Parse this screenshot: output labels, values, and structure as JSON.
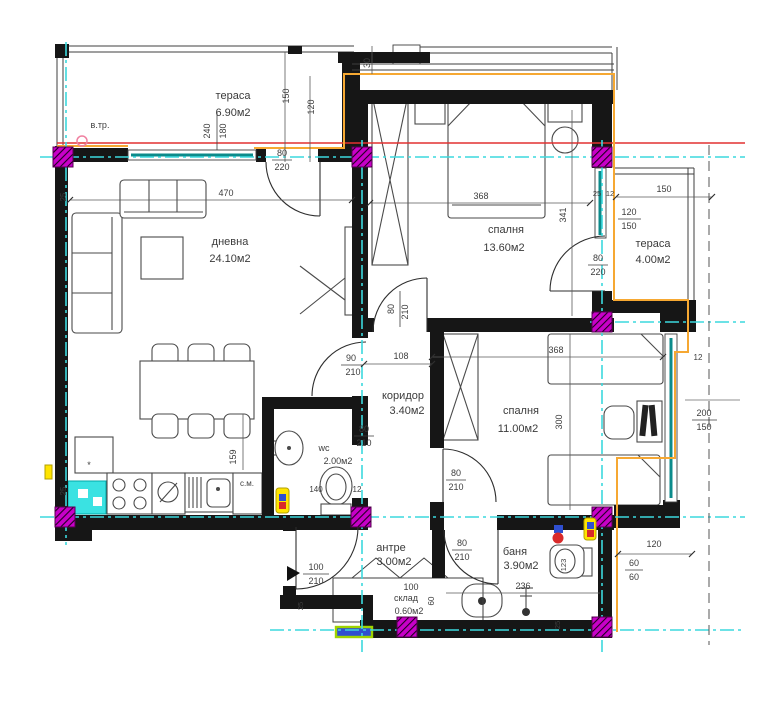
{
  "title": "apartment floor plan",
  "rooms": {
    "terrace_top": {
      "name": "тераса",
      "area": "6.90м2"
    },
    "living": {
      "name": "дневна",
      "area": "24.10м2"
    },
    "bedroom_top": {
      "name": "спалня",
      "area": "13.60м2"
    },
    "terrace_right": {
      "name": "тераса",
      "area": "4.00м2"
    },
    "corridor": {
      "name": "коридор",
      "area": "3.40м2"
    },
    "wc": {
      "name": "wc",
      "area": "2.00м2"
    },
    "bedroom_right": {
      "name": "спалня",
      "area": "11.00м2"
    },
    "entry_hall": {
      "name": "антре",
      "area": "3.00м2"
    },
    "storage": {
      "name": "склад",
      "area": "0.60м2"
    },
    "bathroom": {
      "name": "баня",
      "area": "3.90м2"
    }
  },
  "door_labels": {
    "living_terrace": {
      "w": "80",
      "h": "220"
    },
    "bedroom_terrace": {
      "w": "80",
      "h": "220"
    },
    "living_corridor": {
      "w": "90",
      "h": "210"
    },
    "wc_door": {
      "w": "80",
      "h": "210"
    },
    "bedroom_top_door": {
      "w": "80",
      "h": "210"
    },
    "bedroom_right_door": {
      "w": "80",
      "h": "210"
    },
    "bathroom_door": {
      "w": "80",
      "h": "210"
    },
    "entry_door": {
      "w": "100",
      "h": "210"
    }
  },
  "window_labels": {
    "terrace_window": {
      "w": "240",
      "h": "180"
    },
    "right_window": {
      "num": "120",
      "den": "150"
    },
    "bedroom_right_window": {
      "num": "200",
      "den": "150"
    },
    "small_window": {
      "num": "60",
      "den": "60"
    }
  },
  "dims": {
    "living_width": "470",
    "bed1_width": "368",
    "bed1_height": "341",
    "bed2_width": "368",
    "bed2_height": "300",
    "corridor_width": "108",
    "terrace2_width": "150",
    "t1_v1": "150",
    "t1_v2": "120",
    "top_offset": "30",
    "kitchen_depth": "159",
    "bath_width": "236",
    "window_br": "120",
    "wc_w": "140",
    "wc_o": "12",
    "st_w": "100",
    "st_d": "60",
    "wall1": "25",
    "wall2": "25",
    "wall3": "25",
    "wall4": "25",
    "off1": "25",
    "off2": "12",
    "off3": "12",
    "bath_o": "123"
  },
  "annotations": {
    "vent_shaft": "в.тр.",
    "washing_machine": "с.м.",
    "stove_mark": "*"
  },
  "colors": {
    "wall": "#161616",
    "axis": "#3cd9de",
    "section_line": "#e23030",
    "envelope": "#f6a832",
    "column": "#c800c8",
    "window_glass": "#0c8b8b",
    "fridge_highlight": "#3ae2e2",
    "marker_yellow": "#ffe400",
    "marker_red": "#d92a2a",
    "marker_blue": "#2f4fd0",
    "window_green": "#9ed400"
  }
}
